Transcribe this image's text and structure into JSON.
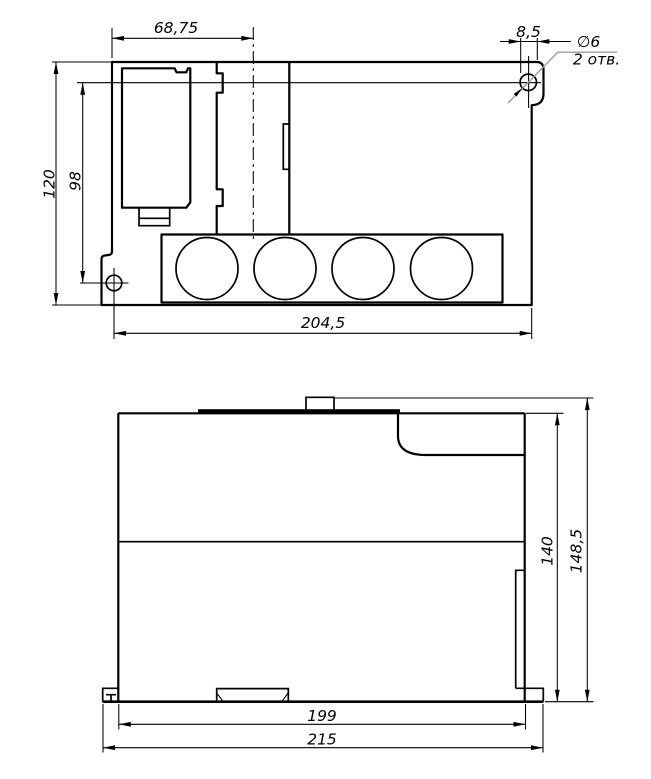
{
  "background": "#ffffff",
  "colors": {
    "line": "#000000",
    "leader": "#9c9c9c"
  },
  "top_view": {
    "dim_width_left": "68,75",
    "dim_ear_offset": "8,5",
    "callout_diameter": "∅6",
    "callout_count": "2 отв.",
    "dim_height_total": "120",
    "dim_holes_vertical": "98",
    "dim_width_total": "204,5"
  },
  "front_view": {
    "dim_height_body": "140",
    "dim_height_total": "148,5",
    "dim_width_body": "199",
    "dim_width_total": "215"
  }
}
